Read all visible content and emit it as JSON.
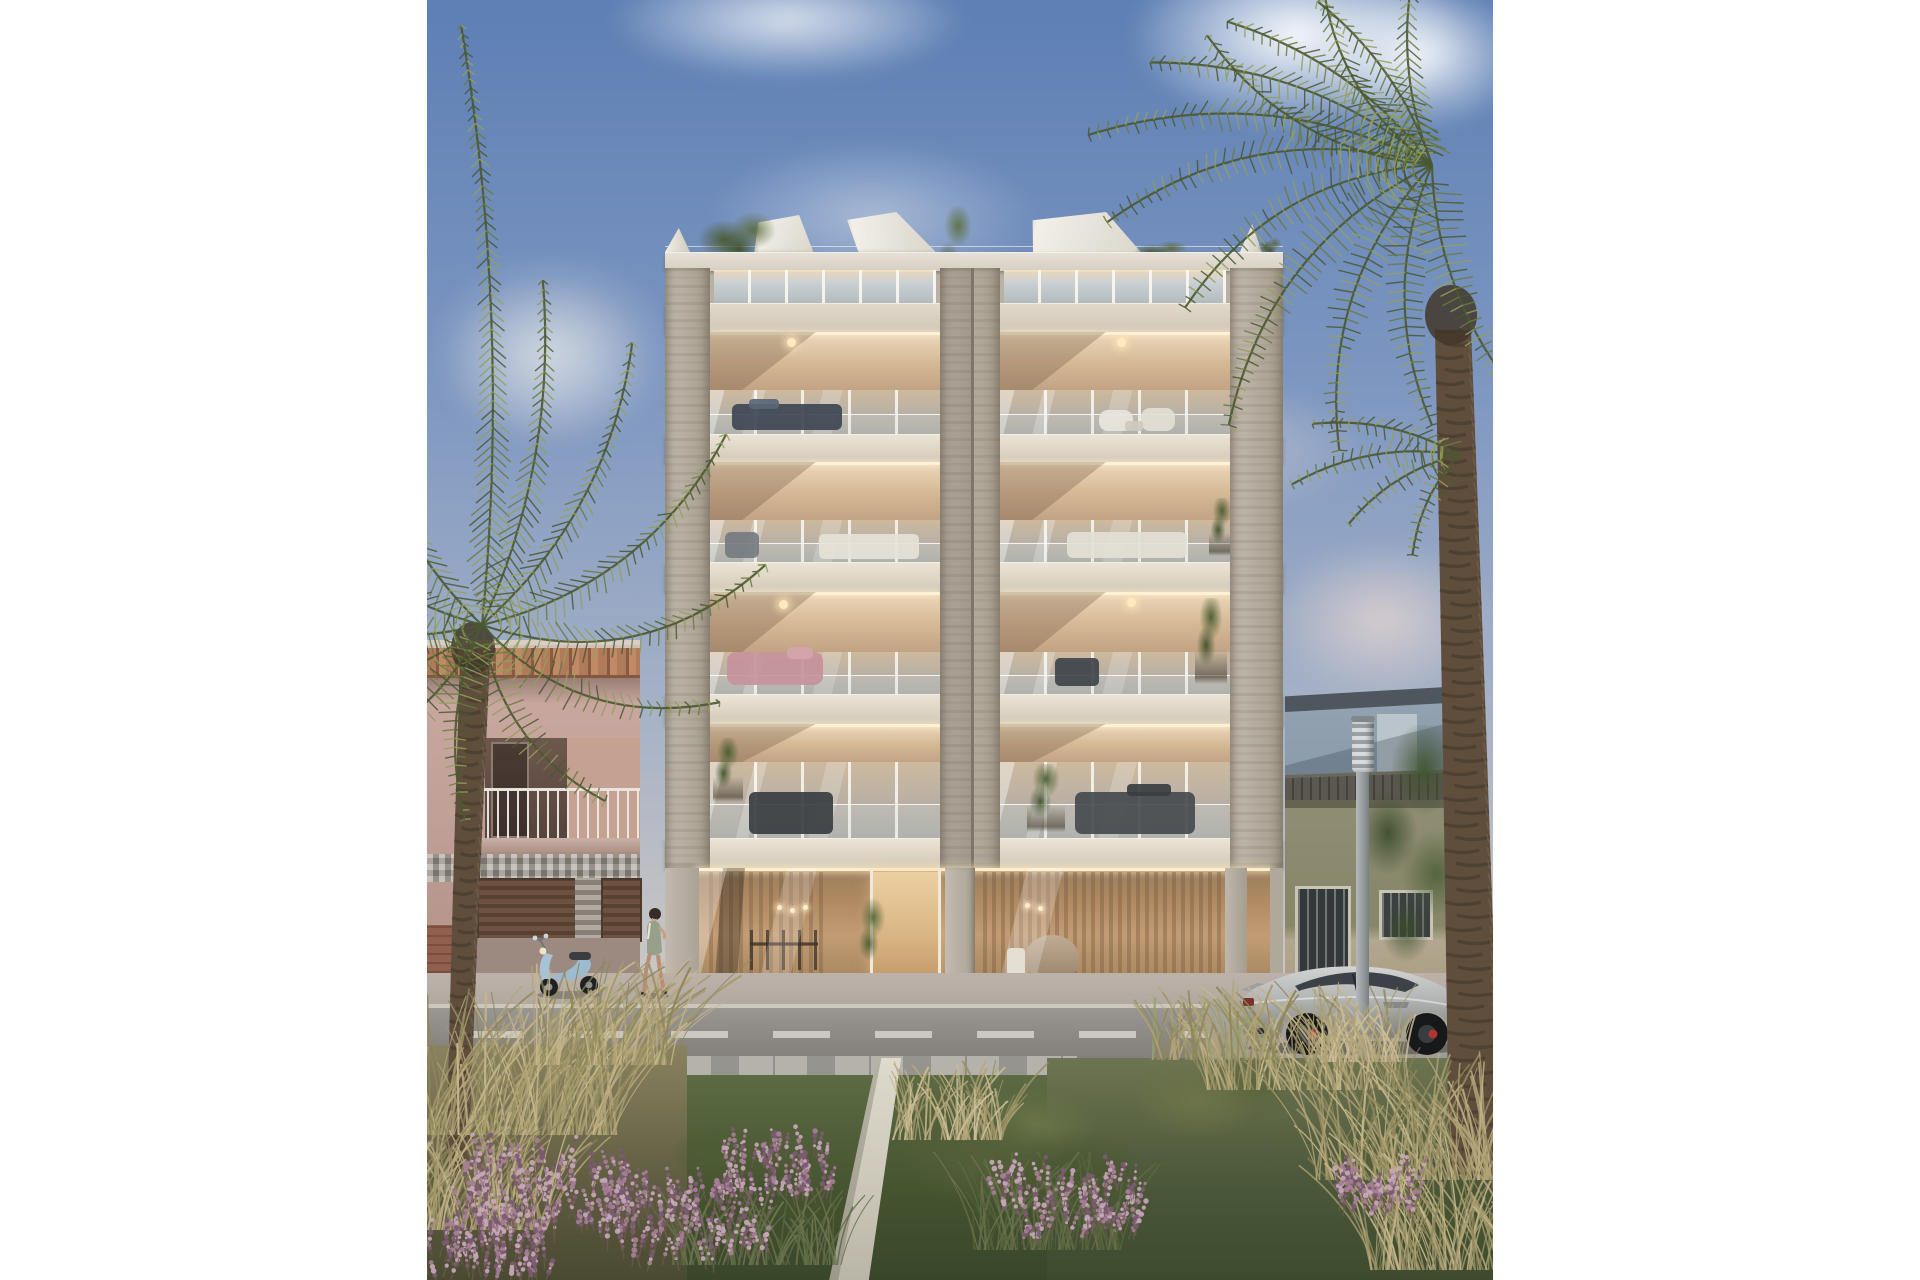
{
  "scene": {
    "type": "architectural-rendering",
    "description": "Sunlit street-view rendering of a modern six-level apartment building with travertine piers, glazed balconies, rooftop pergolas, flanked by palm trees, older neighbouring houses, a parked silver sports car, a scooter, a walking woman and a flowering garden path in the foreground",
    "elements": [
      "sky",
      "clouds",
      "main-building",
      "pink-neighbor-building",
      "grey-house",
      "green-house",
      "street",
      "street-lamp",
      "sports-car",
      "scooter",
      "pedestrian",
      "left-palm",
      "right-palm",
      "garden",
      "walkway"
    ],
    "building": {
      "balcony_floors": 4,
      "bays": 2,
      "has_penthouse": true,
      "has_ground_lobby": true,
      "has_rooftop_pergolas": true
    }
  },
  "palette": {
    "sky_top": "#5d7fb4",
    "sky_mid": "#8aa0c4",
    "sky_low": "#c6c6c6",
    "sky_horizon": "#ded6cb",
    "cloud_white": "#ffffff",
    "travertine_light": "#bcb4a7",
    "travertine_dark": "#a29a8c",
    "pier_groove": "#7e7668",
    "parapet": "#ddd8ce",
    "pergola_white": "#efece4",
    "slab_light": "#ece4d6",
    "slab_dark": "#d2c9b8",
    "slab_shadow": "#6e5f4e",
    "ceiling_light": "#e9d6b8",
    "ceiling_dark": "#b3957a",
    "cove_light": "#fff1d6",
    "glass_warm": "#cdb99e",
    "glass_cool": "#a3a49f",
    "mullion": "#faf8f2",
    "lobby_warm": "#c2996f",
    "lobby_deep": "#7c5f45",
    "entry_glow": "#e8c89c",
    "pink_wall": "#c8a79f",
    "tile_orange": "#b07b5b",
    "tile_shadow": "#845741",
    "mosaic_grey": "#a59e94",
    "shutter_brown": "#6d5244",
    "brick_red": "#915f4d",
    "grey_house_wall": "#93a2b0",
    "grey_house_roof": "#4e565e",
    "grey_house_door": "#bac4cb",
    "green_house_wall": "#8f8d74",
    "green_house_base": "#b2a78f",
    "green_house_door": "#33383b",
    "roof_tiles": "#56544e",
    "asphalt": "#98948f",
    "asphalt_dark": "#7e7c78",
    "sidewalk": "#b7b0a8",
    "paver_light": "#b5b2ab",
    "paver_dark": "#8f8d88",
    "lane_mark": "#dcd8d0",
    "path_concrete": "#d5d0c2",
    "car_body": "#b9bbb9",
    "car_glass": "#3c4248",
    "wheel_dark": "#17181a",
    "caliper_red": "#b23430",
    "tail_light": "#7c322c",
    "lamp_metal": "#9da2a5",
    "lamp_head": "#c6cacc",
    "palm_green": "#6b7a42",
    "palm_green_dark": "#4a5830",
    "palm_green_light": "#93a05e",
    "trunk_brown": "#5f4e3c",
    "trunk_dark": "#42372a",
    "trunk_light": "#7d6a55",
    "lawn_green": "#5c6b43",
    "lawn_dark": "#3f4c2e",
    "bush_green": "#4d5c33",
    "grass_olive": "#8f865c",
    "grass_tan": "#b3a478",
    "heather_purple": "#a77f98",
    "heather_dark": "#7c5a74",
    "heather_light": "#c9a8bc",
    "dress_green": "#97a08a",
    "skin": "#c9a084",
    "hair_dark": "#362b25",
    "scooter_blue": "#a8c3d6"
  }
}
